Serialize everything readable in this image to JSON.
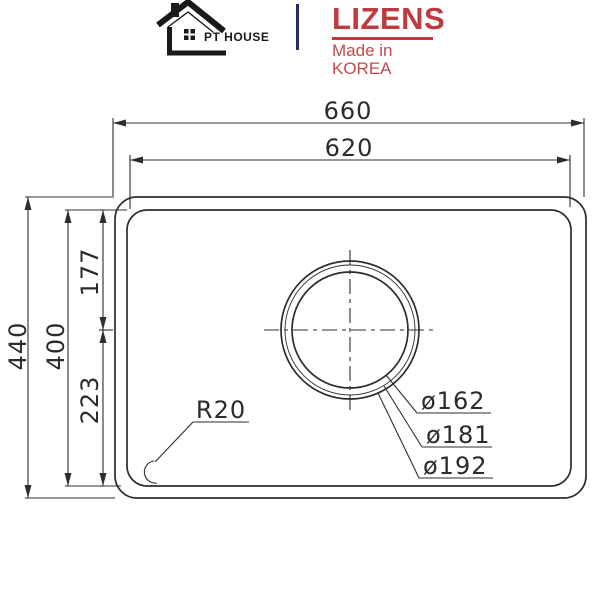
{
  "header": {
    "left_brand": {
      "name": "PT HOUSE"
    },
    "right_brand": {
      "name": "LIZENS",
      "tagline": "Made in KOREA"
    },
    "colors": {
      "brand_red": "#bf3a3e",
      "divider_navy": "#232d5f",
      "logo_black": "#1a1a1a"
    }
  },
  "drawing": {
    "type": "technical-dimension-diagram",
    "subject": "single-bowl sink, top view with drain hole",
    "line_color": "#2d2d2d",
    "dims": {
      "overall_width": "660",
      "inner_width": "620",
      "overall_height": "440",
      "inner_height": "400",
      "drain_from_top": "177",
      "drain_from_bottom": "223",
      "corner_radius_label": "R20",
      "drain_dia_1": "ø162",
      "drain_dia_2": "ø181",
      "drain_dia_3": "ø192"
    }
  }
}
